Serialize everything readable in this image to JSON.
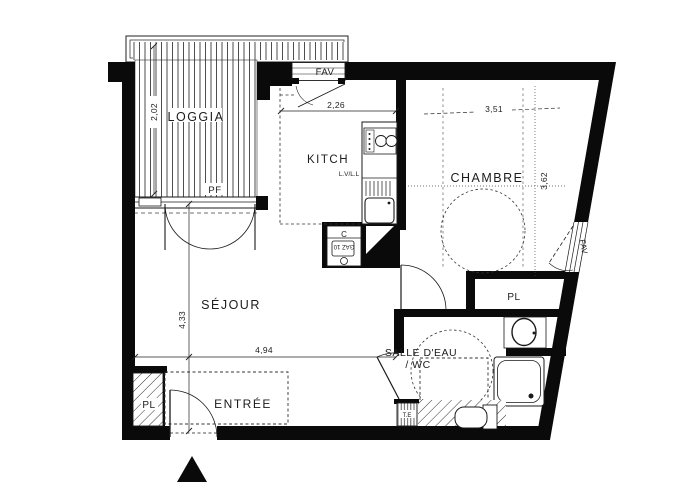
{
  "plan": {
    "title": "studio-apartment-floor-plan",
    "rooms": {
      "loggia": "LOGGIA",
      "kitchen": "KITCH",
      "kitchen_appliances": "L.V/L.L",
      "bedroom": "CHAMBRE",
      "living": "SÉJOUR",
      "entry": "ENTRÉE",
      "bathroom_line1": "SALLE D'EAU",
      "bathroom_line2": "/ WC",
      "closet_living": "PL",
      "closet_bedroom": "PL"
    },
    "labels": {
      "window_loggia": "PF",
      "window_kitchen": "FAV",
      "window_bedroom": "FAV",
      "boiler": "C",
      "boiler_sub": "GAZ 10",
      "electrical_panel": "T.E"
    },
    "dimensions": {
      "loggia_depth": "2,02",
      "kitchen_width": "2,26",
      "bedroom_width": "3,51",
      "bedroom_depth": "3,62",
      "living_depth": "4,33",
      "living_width": "4,94"
    },
    "colors": {
      "wall": "#0a0a0a",
      "line": "#1a1a1a",
      "dash": "#3c3c3c",
      "background": "#ffffff"
    }
  }
}
